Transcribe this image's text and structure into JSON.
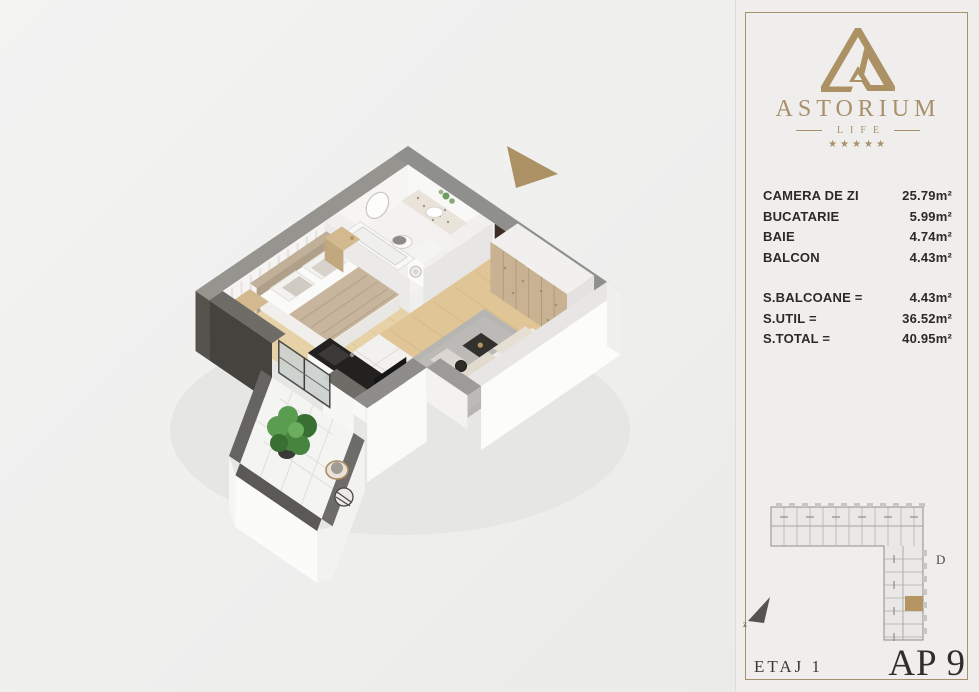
{
  "panel": {
    "brand": {
      "name": "ASTORIUM",
      "sub": "LIFE",
      "stars": "★★★★★"
    },
    "rooms": [
      {
        "label": "CAMERA DE ZI",
        "value": "25.79m²"
      },
      {
        "label": "BUCATARIE",
        "value": "5.99m²"
      },
      {
        "label": "BAIE",
        "value": "4.74m²"
      },
      {
        "label": "BALCON",
        "value": "4.43m²"
      }
    ],
    "totals": [
      {
        "label": "S.BALCOANE =",
        "value": "4.43m²"
      },
      {
        "label": "S.UTIL =",
        "value": "36.52m²"
      },
      {
        "label": "S.TOTAL =",
        "value": "40.95m²"
      }
    ],
    "map": {
      "section_label": "D",
      "compass_label": "z"
    },
    "footer": {
      "floor": "ETAJ 1",
      "apartment": "AP 9"
    }
  },
  "colors": {
    "gold": "#ab9164",
    "panel_border": "#a5926c",
    "text_dark": "#2b2a28",
    "highlight_unit": "#b59662",
    "wall_gray": "#8f8f8d",
    "wood_floor": "#e0c596"
  }
}
